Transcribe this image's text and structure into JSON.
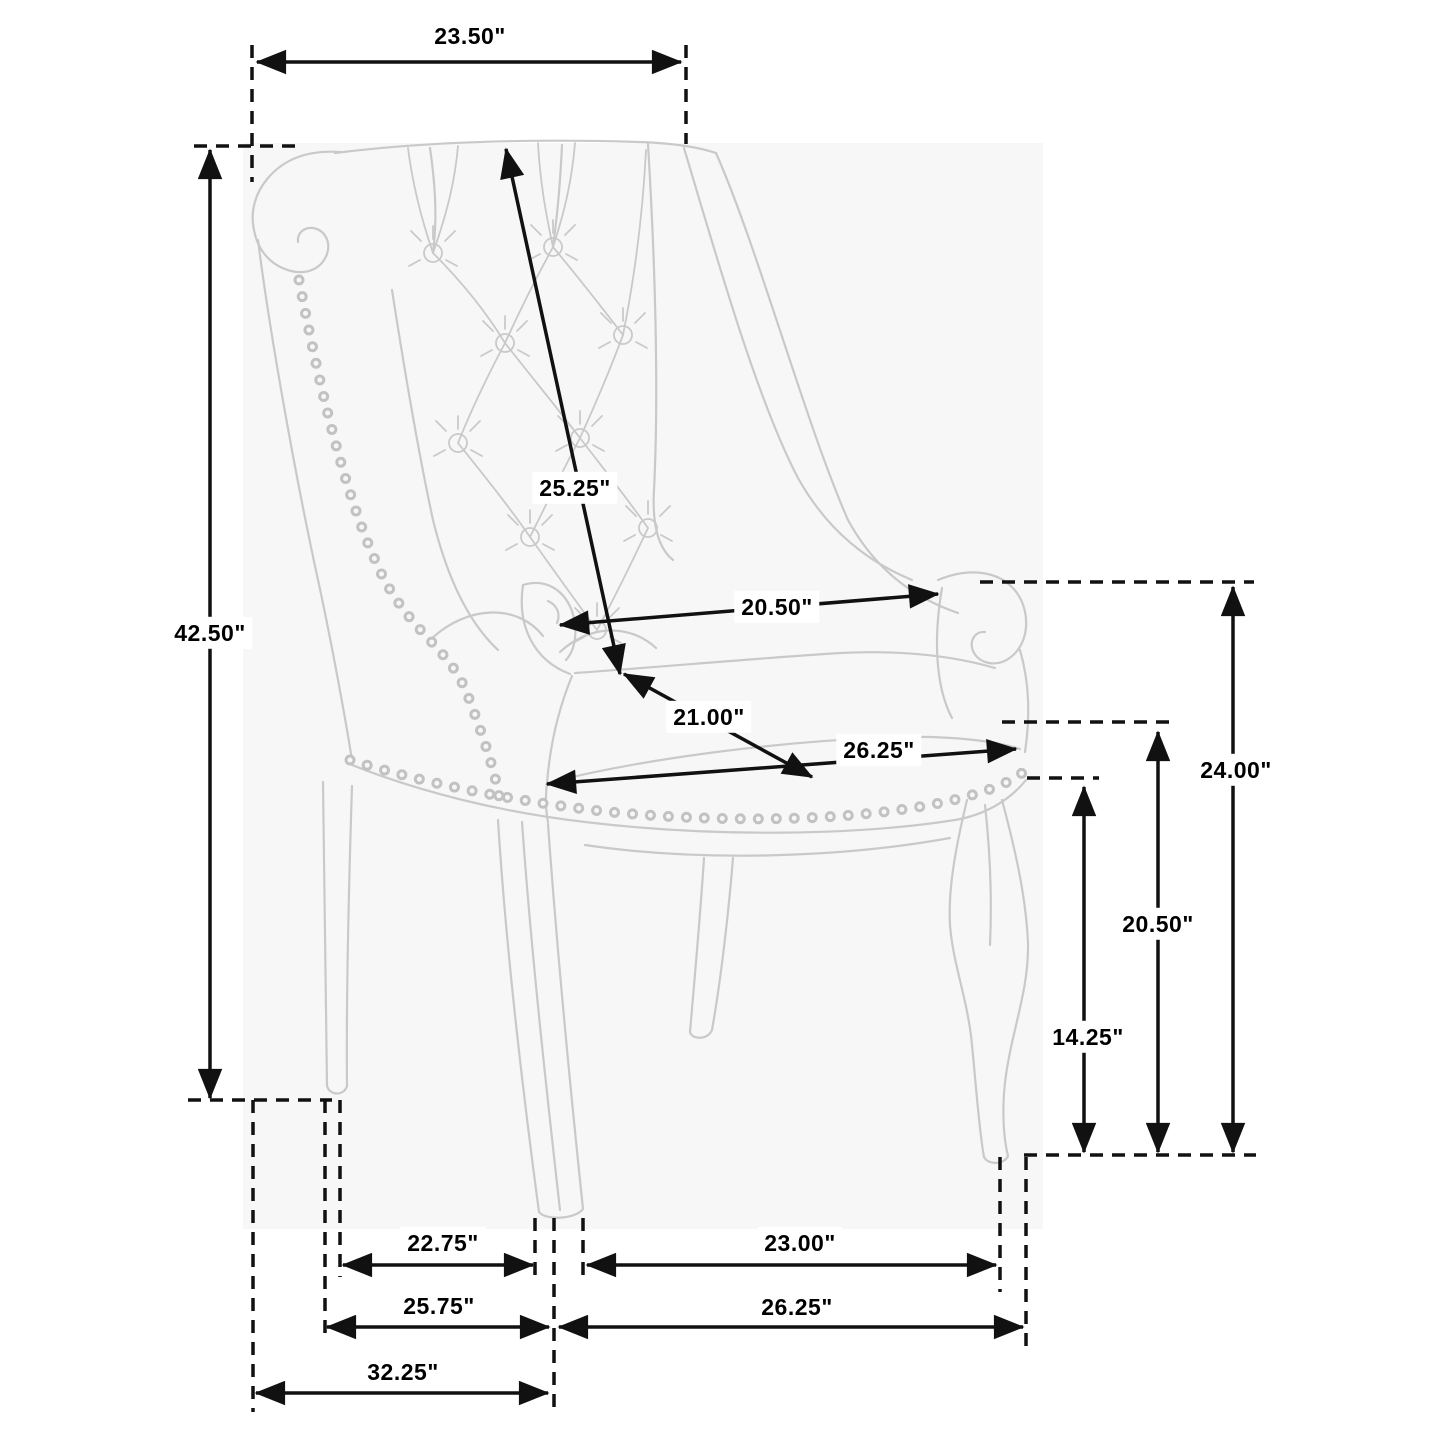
{
  "colors": {
    "dimension_line": "#111111",
    "chair_line": "#c9c9c9",
    "backdrop": "#f7f7f7",
    "label_bg": "#ffffff",
    "label_text": "#000000"
  },
  "dims": {
    "top_width": "23.50\"",
    "overall_height": "42.50\"",
    "back_diagonal": "25.25\"",
    "arm_to_arm": "20.50\"",
    "seat_diagonal_depth": "21.00\"",
    "seat_width": "26.25\"",
    "arm_height": "24.00\"",
    "floor_to_seat_back": "20.50\"",
    "floor_to_apron": "14.25\"",
    "footprint_front_left": "22.75\"",
    "footprint_front_right": "23.00\"",
    "footprint_mid_left": "25.75\"",
    "footprint_mid_right": "26.25\"",
    "footprint_overall_left": "32.25\""
  }
}
